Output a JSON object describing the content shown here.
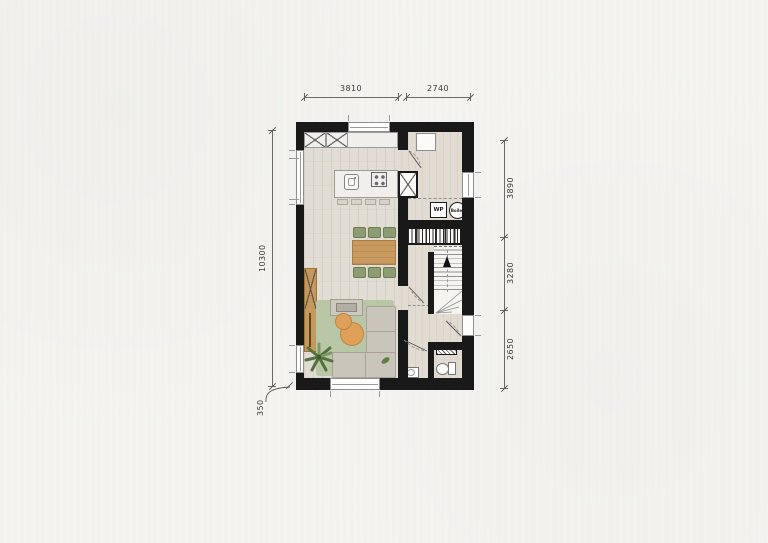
{
  "drawing": {
    "type": "architectural-floor-plan",
    "dimensions": {
      "top": [
        "3810",
        "2740"
      ],
      "right": [
        "3890",
        "3280",
        "2650"
      ],
      "left_total": "10300",
      "bottom_left": "350"
    },
    "equipment": {
      "heat_pump": "WP",
      "boiler": "Boiler"
    },
    "icons": {
      "stairs-direction-arrow": "filled-triangle-up",
      "entrance-arrow": "filled-triangle-left"
    },
    "colors": {
      "paper": "#f5f4f1",
      "wall": "#191919",
      "wood_floor": "#e2ddd4",
      "hall_floor": "#e1dbd1",
      "table_wood": "#c99a5f",
      "chair_green": "#8d9c72",
      "rug_green": "#b9c7a7",
      "sofa_gray": "#c9c5ba",
      "pouf_orange": "#dfa05a",
      "plant_green": "#54713f",
      "dimension_text": "#3c3c3c"
    }
  }
}
